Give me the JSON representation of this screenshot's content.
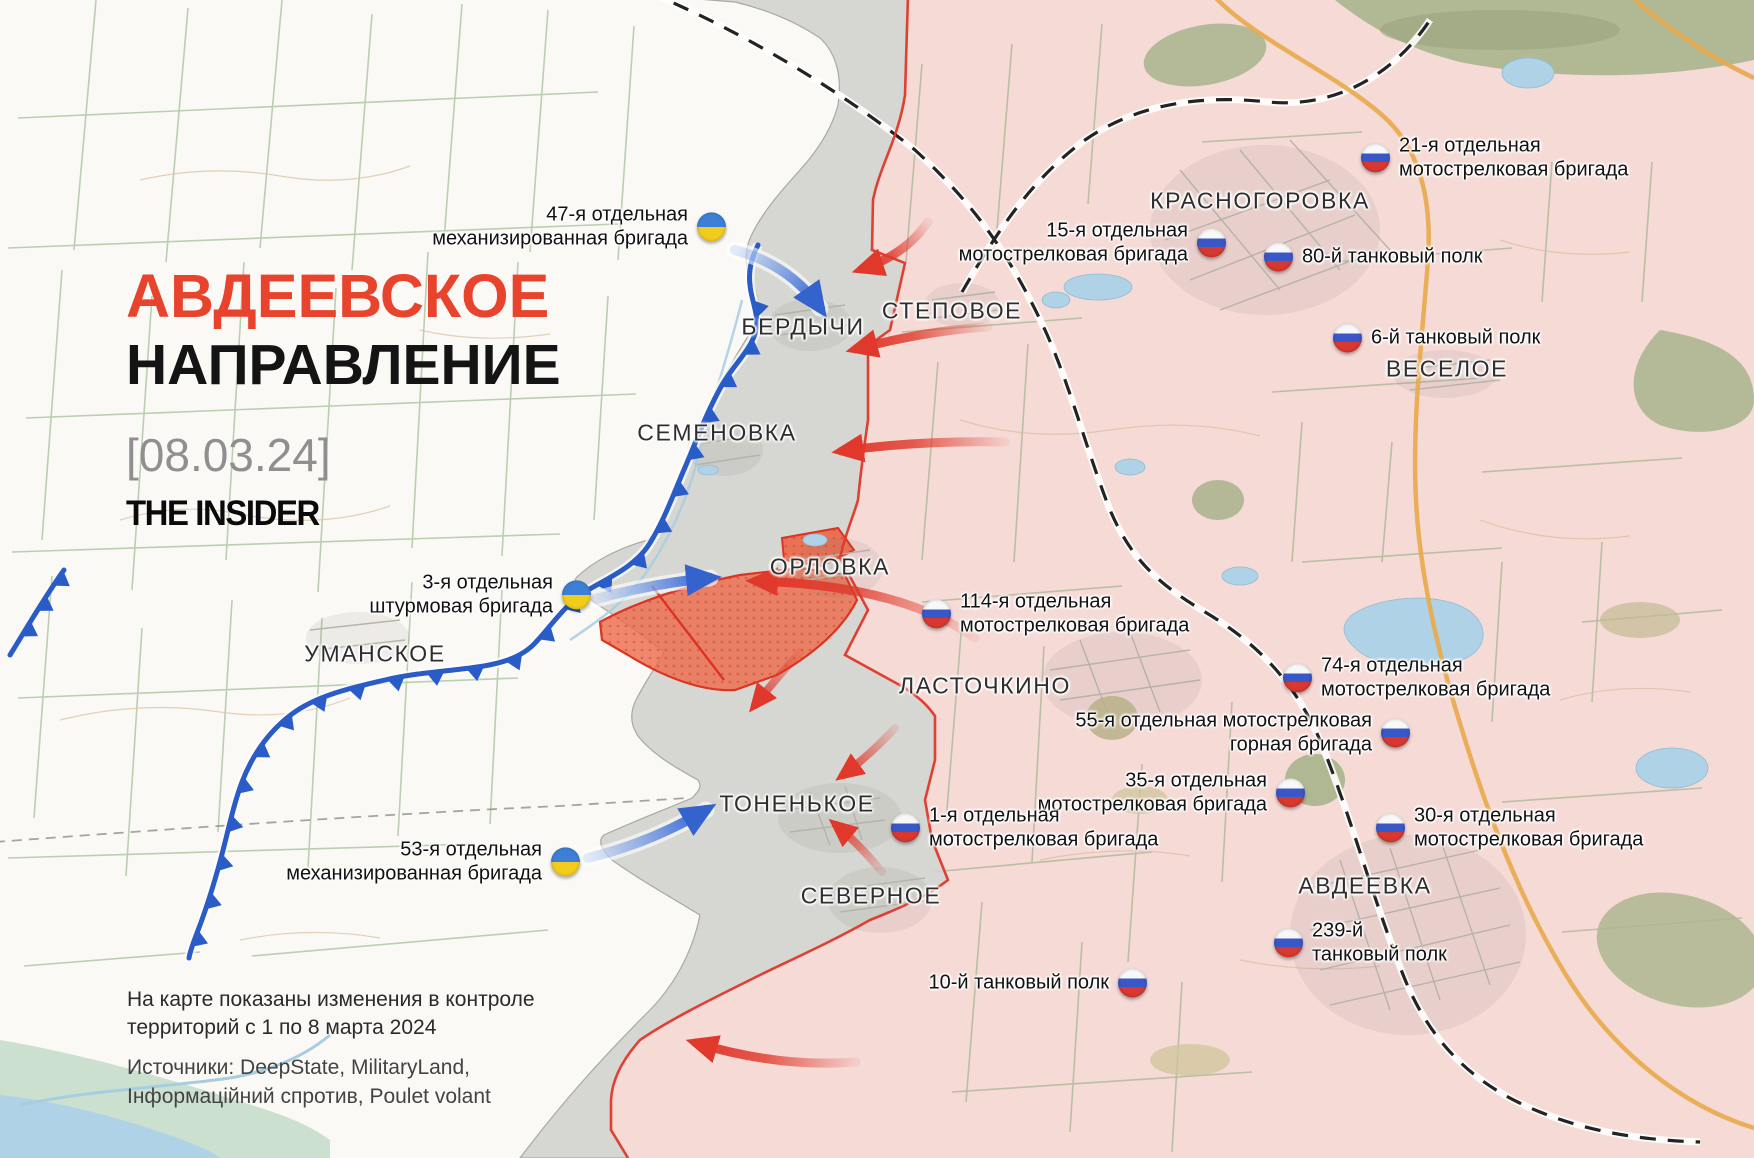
{
  "title": {
    "line1": "АВДЕЕВСКОЕ",
    "line2": "НАПРАВЛЕНИЕ",
    "date": "[08.03.24]",
    "logo": "THE INSIDER"
  },
  "note": {
    "line1": "На карте показаны изменения в контроле",
    "line2": "территорий с 1 по 8 марта 2024",
    "sources_line1": "Источники: DeepState, MilitaryLand,",
    "sources_line2": "Інформаційний спротив, Poulet volant"
  },
  "places": {
    "berdychi": "БЕРДЫЧИ",
    "stepove": "СТЕПОВОЕ",
    "semenivka": "СЕМЕНОВКА",
    "orlivka": "ОРЛОВКА",
    "umanske": "УМАНСКОЕ",
    "lastochkyne": "ЛАСТОЧКИНО",
    "tonenke": "ТОНЕНЬКОЕ",
    "severne": "СЕВЕРНОЕ",
    "krasnohorivka": "КРАСНОГОРОВКА",
    "vesele": "ВЕСЕЛОЕ",
    "avdiivka": "АВДЕЕВКА"
  },
  "units": {
    "ua47": {
      "country": "Ukraine",
      "line1": "47-я отдельная",
      "line2": "механизированная бригада"
    },
    "ua3": {
      "country": "Ukraine",
      "line1": "3-я отдельная",
      "line2": "штурмовая бригада"
    },
    "ua53": {
      "country": "Ukraine",
      "line1": "53-я отдельная",
      "line2": "механизированная бригада"
    },
    "ru21": {
      "country": "Russia",
      "line1": "21-я отдельная",
      "line2": "мотострелковая бригада"
    },
    "ru15": {
      "country": "Russia",
      "line1": "15-я отдельная",
      "line2": "мотострелковая бригада"
    },
    "ru80": {
      "country": "Russia",
      "line1": "80-й танковый полк"
    },
    "ru6": {
      "country": "Russia",
      "line1": "6-й танковый полк"
    },
    "ru114": {
      "country": "Russia",
      "line1": "114-я отдельная",
      "line2": "мотострелковая бригада"
    },
    "ru74": {
      "country": "Russia",
      "line1": "74-я отдельная",
      "line2": "мотострелковая бригада"
    },
    "ru55": {
      "country": "Russia",
      "line1": "55-я отдельная мотострелковая",
      "line2": "горная бригада"
    },
    "ru35": {
      "country": "Russia",
      "line1": "35-я отдельная",
      "line2": "мотострелковая бригада"
    },
    "ru30": {
      "country": "Russia",
      "line1": "30-я отдельная",
      "line2": "мотострелковая бригада"
    },
    "ru1": {
      "country": "Russia",
      "line1": "1-я отдельная",
      "line2": "мотострелковая бригада"
    },
    "ru239": {
      "country": "Russia",
      "line1": "239-й",
      "line2": "танковый полк"
    },
    "ru10": {
      "country": "Russia",
      "line1": "10-й танковый полк"
    }
  },
  "colors": {
    "title_accent": "#E8432D",
    "ru_controlled_territory": "#F5DAD6",
    "contested_gray_zone": "#D2D2CE",
    "recent_advance_orange": "#EE6A4A",
    "front_line_blue": "#2A5CC8",
    "attack_arrow_red": "#E0382A",
    "ua_arrow_blue": "#3B6FD8",
    "ukraine_flag_blue": "#3D7FD6",
    "ukraine_flag_yellow": "#F2CC1D",
    "russia_flag_blue": "#3A57C8",
    "russia_flag_red": "#D7382F"
  }
}
